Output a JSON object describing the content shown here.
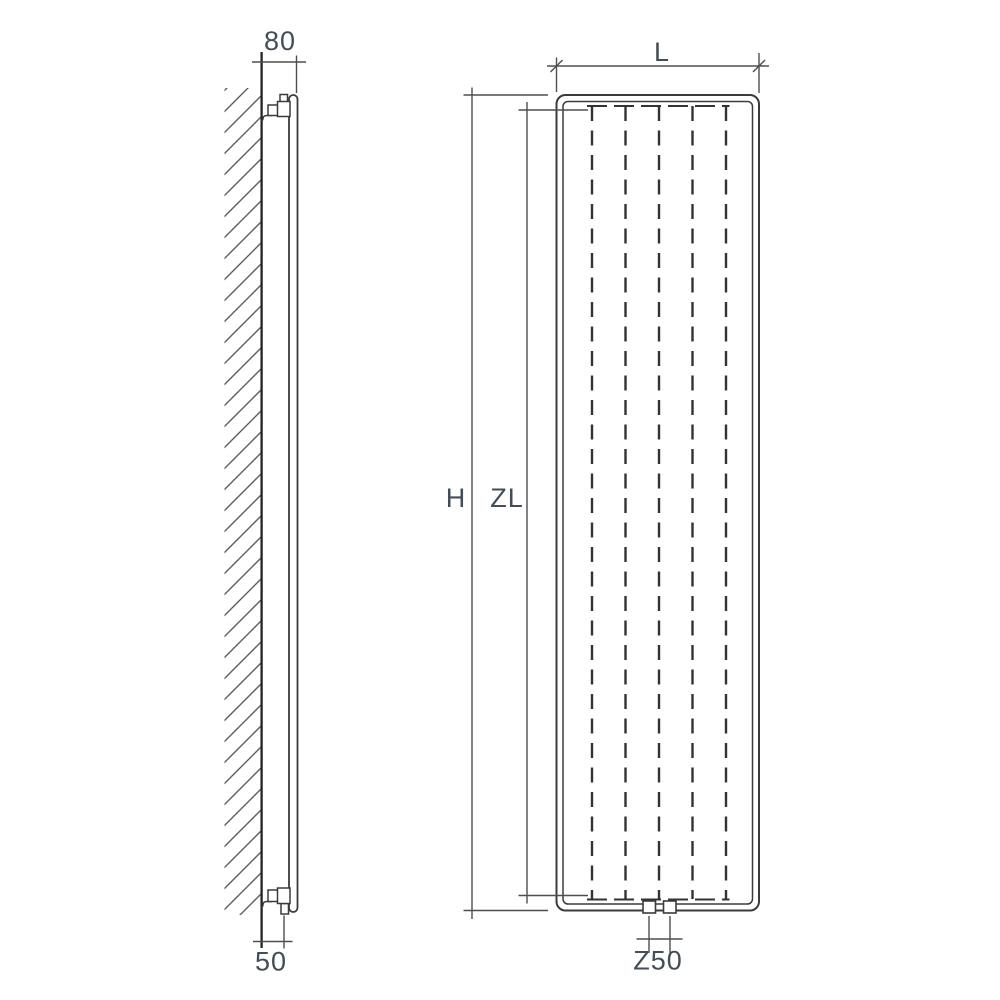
{
  "diagram": {
    "side_view": {
      "depth_dimension": "80",
      "bottom_clearance_dimension": "50"
    },
    "front_view": {
      "width_dimension": "L",
      "height_dimension": "H",
      "inner_length_dimension": "ZL",
      "connection_spacing_dimension": "Z50"
    },
    "colors": {
      "line": "#3b3b3b",
      "dimension_line": "#4e4e4e",
      "label": "#434c59",
      "background": "#ffffff"
    }
  }
}
